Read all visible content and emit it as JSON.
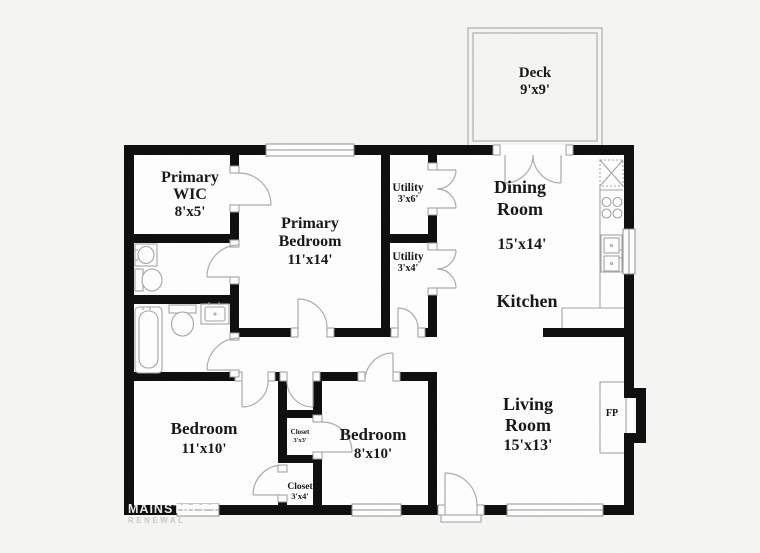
{
  "colors": {
    "wall": "#0b0b0b",
    "background": "#f6f6f4",
    "floor": "#ffffff",
    "thin_line": "#a3a3a3"
  },
  "rooms": {
    "primary_wic": {
      "line1": "Primary",
      "line2": "WIC",
      "dims": "8'x5'"
    },
    "primary_bedroom": {
      "line1": "Primary",
      "line2": "Bedroom",
      "dims": "11'x14'"
    },
    "utility_1": {
      "name": "Utility",
      "dims": "3'x6'"
    },
    "utility_2": {
      "name": "Utility",
      "dims": "3'x4'"
    },
    "dining_room": {
      "line1": "Dining",
      "line2": "Room",
      "dims": "15'x14'"
    },
    "kitchen": {
      "name": "Kitchen"
    },
    "living_room": {
      "line1": "Living",
      "line2": "Room",
      "dims": "15'x13'"
    },
    "bedroom_1": {
      "name": "Bedroom",
      "dims": "11'x10'"
    },
    "bedroom_2": {
      "name": "Bedroom",
      "dims": "8'x10'"
    },
    "closet_1": {
      "name": "Closet",
      "dims": "3'x3'"
    },
    "closet_2": {
      "name": "Closet",
      "dims": "3'x4'"
    },
    "deck": {
      "name": "Deck",
      "dims": "9'x9'"
    },
    "fireplace": {
      "abbr": "FP"
    }
  },
  "watermark": {
    "line1": "MAINSTREET",
    "line2": "RENEWAL"
  }
}
